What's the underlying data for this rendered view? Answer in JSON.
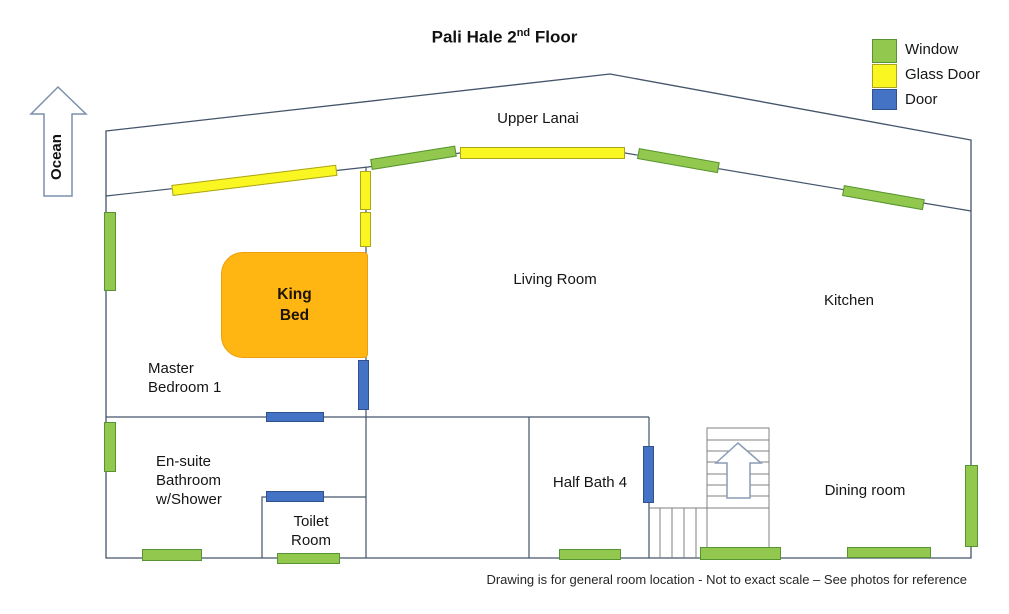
{
  "title": {
    "prefix": "Pali Hale 2",
    "superscript": "nd",
    "suffix": " Floor"
  },
  "legend": {
    "items": [
      {
        "label": "Window",
        "color": "#92c84e"
      },
      {
        "label": "Glass Door",
        "color": "#f9f622"
      },
      {
        "label": "Door",
        "color": "#4472c4"
      }
    ]
  },
  "compass": {
    "label": "Ocean",
    "direction": "up"
  },
  "rooms": {
    "upper_lanai": "Upper Lanai",
    "living_room": "Living Room",
    "kitchen": "Kitchen",
    "master_bedroom": {
      "line1": "Master",
      "line2": "Bedroom 1"
    },
    "king_bed": {
      "line1": "King",
      "line2": "Bed"
    },
    "ensuite": {
      "line1": "En-suite",
      "line2": "Bathroom",
      "line3": "w/Shower"
    },
    "toilet_room": {
      "line1": "Toilet",
      "line2": "Room"
    },
    "half_bath": "Half Bath 4",
    "dining_room": "Dining room"
  },
  "footer": "Drawing is for general room location - Not to exact scale – See photos for reference",
  "colors": {
    "window_fill": "#92c84e",
    "window_border": "#569332",
    "glass_door_fill": "#f9f622",
    "glass_door_border": "#aba41c",
    "door_fill": "#4472c4",
    "door_border": "#2f528f",
    "bed_fill": "#ffb612",
    "wall_line": "#44546a",
    "stairs_line": "#808080",
    "arrow_outline": "#7c90ac"
  },
  "features": {
    "windows": [
      "master bedroom left wall",
      "en-suite left wall",
      "lanai wall left of glass door",
      "lanai wall right of glass door",
      "kitchen top wall",
      "en-suite bottom wall",
      "toilet room bottom wall",
      "half bath bottom wall",
      "stair landing bottom wall",
      "dining room bottom wall",
      "dining room right wall"
    ],
    "glass_doors": [
      "master bedroom to lanai (slanted)",
      "living room to lanai (wide)",
      "living room wall upper segment",
      "living room wall lower segment"
    ],
    "doors": [
      "master bedroom to living area",
      "en-suite bathroom entry",
      "toilet room entry",
      "half bath entry"
    ],
    "stairs": "L-shaped staircase with up arrow"
  }
}
